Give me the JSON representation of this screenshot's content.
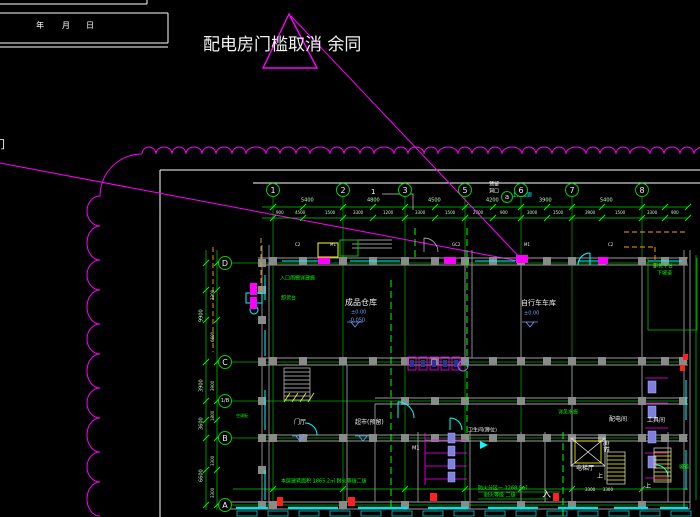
{
  "palette": {
    "line_green": "#00d000",
    "bright_green": "#00ff00",
    "cyan": "#00ffff",
    "magenta": "#ff00ff",
    "yellow": "#ffff00",
    "white": "#f2f2f2",
    "wall_gray": "#9a9a9a",
    "column_gray": "#8a8a8a",
    "elev_blue": "#6f9fff",
    "fixture_purple": "#8080e0",
    "orange": "#ffa000",
    "red": "#ff2020",
    "dim_text": "#b8ffb8"
  },
  "revision_note": {
    "text": "配电房门槛取消 余同"
  },
  "title_block": {
    "fields": [
      "年",
      "月",
      "日"
    ]
  },
  "grid": {
    "top": [
      {
        "label": "1",
        "x": 273
      },
      {
        "label": "2",
        "x": 343
      },
      {
        "label": "3",
        "x": 405
      },
      {
        "label": "5",
        "x": 465
      },
      {
        "label": "6",
        "x": 521
      },
      {
        "label": "7",
        "x": 572
      },
      {
        "label": "8",
        "x": 642
      }
    ],
    "top_aux": {
      "label": "a",
      "x": 507,
      "y": 197
    },
    "left": [
      {
        "label": "D",
        "y": 263
      },
      {
        "label": "C",
        "y": 362
      },
      {
        "label": "1/B",
        "y": 401
      },
      {
        "label": "B",
        "y": 438
      },
      {
        "label": "A",
        "y": 505
      }
    ]
  },
  "dimensions": {
    "top_row1": {
      "y": 198,
      "items": [
        {
          "v": "5400",
          "x": 308
        },
        {
          "v": "4800",
          "x": 374
        },
        {
          "v": "4500",
          "x": 435
        },
        {
          "v": "4200",
          "x": 493
        },
        {
          "v": "3900",
          "x": 546
        },
        {
          "v": "5400",
          "x": 607
        }
      ]
    },
    "top_row2": {
      "y": 211,
      "items": [
        {
          "v": "900",
          "x": 281
        },
        {
          "v": "4500",
          "x": 300
        },
        {
          "v": "1500",
          "x": 330
        },
        {
          "v": "3300",
          "x": 358
        },
        {
          "v": "1200",
          "x": 388
        },
        {
          "v": "3300",
          "x": 420
        },
        {
          "v": "1500",
          "x": 450
        },
        {
          "v": "2700",
          "x": 478
        },
        {
          "v": "900",
          "x": 505
        },
        {
          "v": "3000",
          "x": 532
        },
        {
          "v": "1500",
          "x": 558
        },
        {
          "v": "3900",
          "x": 590
        },
        {
          "v": "1500",
          "x": 620
        },
        {
          "v": "3300",
          "x": 652
        },
        {
          "v": "900",
          "x": 676
        }
      ]
    },
    "left_row1": {
      "x": 199,
      "items": [
        {
          "v": "9900",
          "y": 312
        },
        {
          "v": "3900",
          "y": 382
        },
        {
          "v": "3600",
          "y": 420
        },
        {
          "v": "6600",
          "y": 472
        }
      ]
    },
    "left_row2": {
      "x": 211,
      "items": [
        {
          "v": "3300",
          "y": 292
        },
        {
          "v": "6600",
          "y": 334
        },
        {
          "v": "3900",
          "y": 383
        },
        {
          "v": "1800",
          "y": 413
        },
        {
          "v": "3300",
          "y": 458
        },
        {
          "v": "3300",
          "y": 490
        }
      ]
    }
  },
  "annotations": [
    {
      "t": "配电房门槛取消 余同",
      "x": 203,
      "y": 37,
      "c": "#f2f2f2",
      "s": 17
    },
    {
      "t": "年",
      "x": 36,
      "y": 22,
      "c": "#ffffff",
      "s": 8
    },
    {
      "t": "月",
      "x": 62,
      "y": 22,
      "c": "#ffffff",
      "s": 8
    },
    {
      "t": "日",
      "x": 86,
      "y": 22,
      "c": "#ffffff",
      "s": 8
    },
    {
      "t": "门",
      "x": -6,
      "y": 139,
      "c": "#ffffff",
      "s": 11
    },
    {
      "t": "1",
      "x": 371,
      "y": 189,
      "c": "#ffffff",
      "s": 7
    },
    {
      "t": "上接连廊",
      "x": 512,
      "y": 193,
      "c": "#00ffff",
      "s": 5
    },
    {
      "t": "预留",
      "x": 489,
      "y": 182,
      "c": "#ffffff",
      "s": 5
    },
    {
      "t": "洞口",
      "x": 489,
      "y": 189,
      "c": "#ffffff",
      "s": 5
    },
    {
      "t": "入口雨棚详建施",
      "x": 280,
      "y": 276,
      "c": "#00ff00",
      "s": 5
    },
    {
      "t": "卸货台",
      "x": 281,
      "y": 296,
      "c": "#00ff00",
      "s": 5
    },
    {
      "t": "成品仓库",
      "x": 345,
      "y": 299,
      "c": "#f2f2f2",
      "s": 8
    },
    {
      "t": "±0.00",
      "x": 351,
      "y": 310,
      "c": "#6f9fff",
      "s": 5
    },
    {
      "t": "-0.050",
      "x": 349,
      "y": 318,
      "c": "#6f9fff",
      "s": 5
    },
    {
      "t": "自行车车库",
      "x": 521,
      "y": 300,
      "c": "#f2f2f2",
      "s": 7
    },
    {
      "t": "±0.00",
      "x": 524,
      "y": 311,
      "c": "#6f9fff",
      "s": 5
    },
    {
      "t": "门厅",
      "x": 294,
      "y": 420,
      "c": "#f2f2f2",
      "s": 6
    },
    {
      "t": "超市(预留)",
      "x": 355,
      "y": 420,
      "c": "#f2f2f2",
      "s": 6
    },
    {
      "t": "卫生间(蹲位)",
      "x": 468,
      "y": 428,
      "c": "#f2f2f2",
      "s": 5
    },
    {
      "t": "M1",
      "x": 412,
      "y": 446,
      "c": "#ffffff",
      "s": 5
    },
    {
      "t": "配电间",
      "x": 609,
      "y": 417,
      "c": "#f2f2f2",
      "s": 6
    },
    {
      "t": "工具间",
      "x": 647,
      "y": 418,
      "c": "#f2f2f2",
      "s": 6
    },
    {
      "t": "电梯",
      "x": 608,
      "y": 440,
      "c": "#f2f2f2",
      "s": 6,
      "r": 90
    },
    {
      "t": "电梯厅",
      "x": 576,
      "y": 466,
      "c": "#f2f2f2",
      "s": 6
    },
    {
      "t": "上",
      "x": 597,
      "y": 474,
      "c": "#ffffff",
      "s": 6
    },
    {
      "t": "上",
      "x": 645,
      "y": 484,
      "c": "#ffffff",
      "s": 6
    },
    {
      "t": "详见水施",
      "x": 558,
      "y": 410,
      "c": "#00ff00",
      "s": 5
    },
    {
      "t": "本层建筑面积 1865.2㎡ 耐火等级二级",
      "x": 281,
      "y": 479,
      "c": "#00ff00",
      "s": 5
    },
    {
      "t": "防火分区一 1268.5㎡",
      "x": 478,
      "y": 486,
      "c": "#00ff00",
      "s": 5
    },
    {
      "t": "耐火等级 二级",
      "x": 484,
      "y": 493,
      "c": "#00ff00",
      "s": 5
    },
    {
      "t": "卸货平台",
      "x": 653,
      "y": 264,
      "c": "#00ff00",
      "s": 5
    },
    {
      "t": "下坡道",
      "x": 657,
      "y": 271,
      "c": "#00ff00",
      "s": 5
    },
    {
      "t": "坡道",
      "x": 679,
      "y": 465,
      "c": "#00ff00",
      "s": 5
    },
    {
      "t": "入",
      "x": 542,
      "y": 491,
      "c": "#f2f2f2",
      "s": 9
    },
    {
      "t": "3300      3300",
      "x": 585,
      "y": 488,
      "c": "#e8e8e8",
      "s": 4
    },
    {
      "t": "C2",
      "x": 295,
      "y": 243,
      "c": "#eeeeee",
      "s": 4
    },
    {
      "t": "M1",
      "x": 330,
      "y": 243,
      "c": "#eeeeee",
      "s": 4
    },
    {
      "t": "GC2",
      "x": 452,
      "y": 243,
      "c": "#eeeeee",
      "s": 4
    },
    {
      "t": "M1",
      "x": 524,
      "y": 243,
      "c": "#eeeeee",
      "s": 4
    },
    {
      "t": "C2",
      "x": 608,
      "y": 243,
      "c": "#eeeeee",
      "s": 4
    },
    {
      "t": "空调板",
      "x": 236,
      "y": 414,
      "c": "#00ff00",
      "s": 4
    }
  ],
  "elevation_markers": [
    [
      355,
      322
    ],
    [
      530,
      322
    ],
    [
      300,
      436
    ],
    [
      363,
      436
    ]
  ]
}
